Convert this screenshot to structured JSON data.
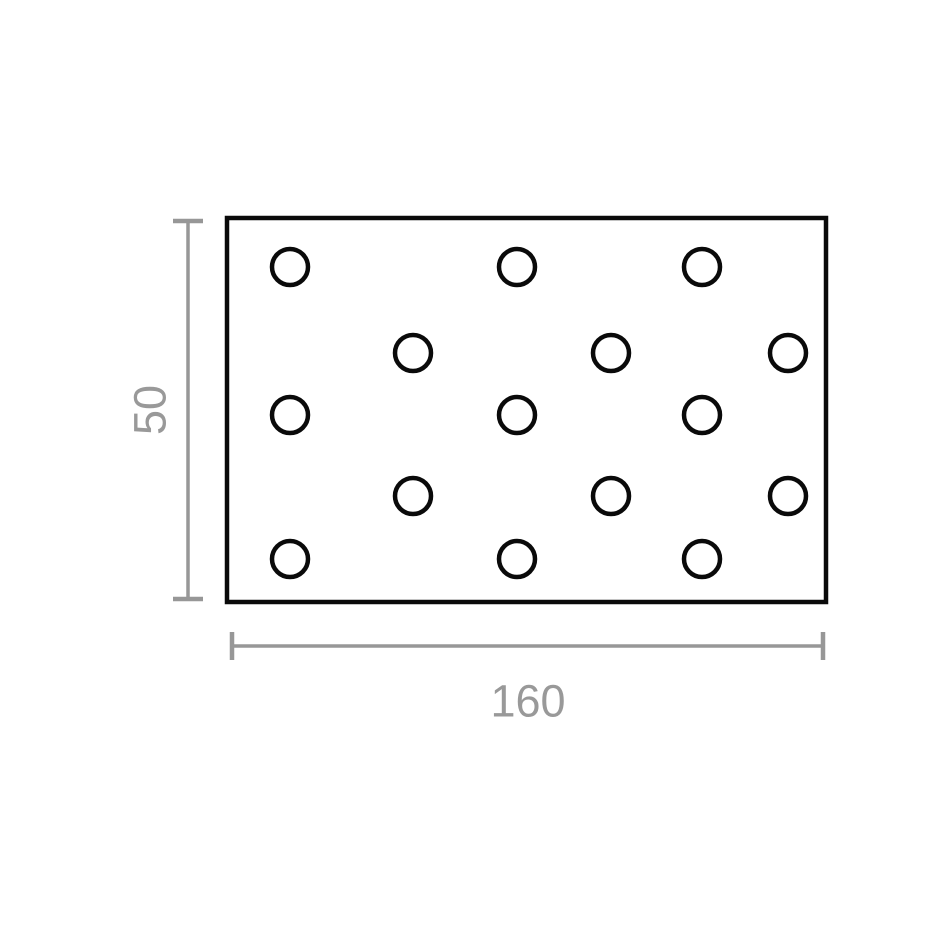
{
  "diagram": {
    "type": "technical-drawing",
    "subject": "perforated-flat-plate",
    "width_label": "160",
    "height_label": "50",
    "colors": {
      "outline": "#0a0a0a",
      "hole": "#0a0a0a",
      "dimension": "#979797",
      "label": "#999999",
      "fill": "#ffffff",
      "background": "#ffffff"
    },
    "plate": {
      "x": 227,
      "y": 218,
      "width": 599,
      "height": 384,
      "stroke_width": 4.5
    },
    "holes": {
      "radius": 18,
      "stroke_width": 4.5,
      "centers": [
        [
          290,
          267
        ],
        [
          517,
          267
        ],
        [
          702,
          267
        ],
        [
          413,
          353
        ],
        [
          611,
          353
        ],
        [
          788,
          353
        ],
        [
          290,
          415
        ],
        [
          517,
          415
        ],
        [
          702,
          415
        ],
        [
          413,
          496
        ],
        [
          611,
          496
        ],
        [
          788,
          496
        ],
        [
          290,
          559
        ],
        [
          517,
          559
        ],
        [
          702,
          559
        ]
      ]
    },
    "dim_vertical": {
      "line_x": 188,
      "y1": 221,
      "y2": 599,
      "cap_half_length": 15,
      "line_width": 3.5,
      "cap_width": 4.5,
      "label_x": 150,
      "label_y": 410,
      "label_rotation": -90
    },
    "dim_horizontal": {
      "line_y": 646,
      "x1": 232,
      "x2": 823,
      "cap_half_length": 14,
      "line_width": 3.5,
      "cap_width": 4.5,
      "label_x": 528,
      "label_y": 701
    },
    "label_font_size": 45
  }
}
